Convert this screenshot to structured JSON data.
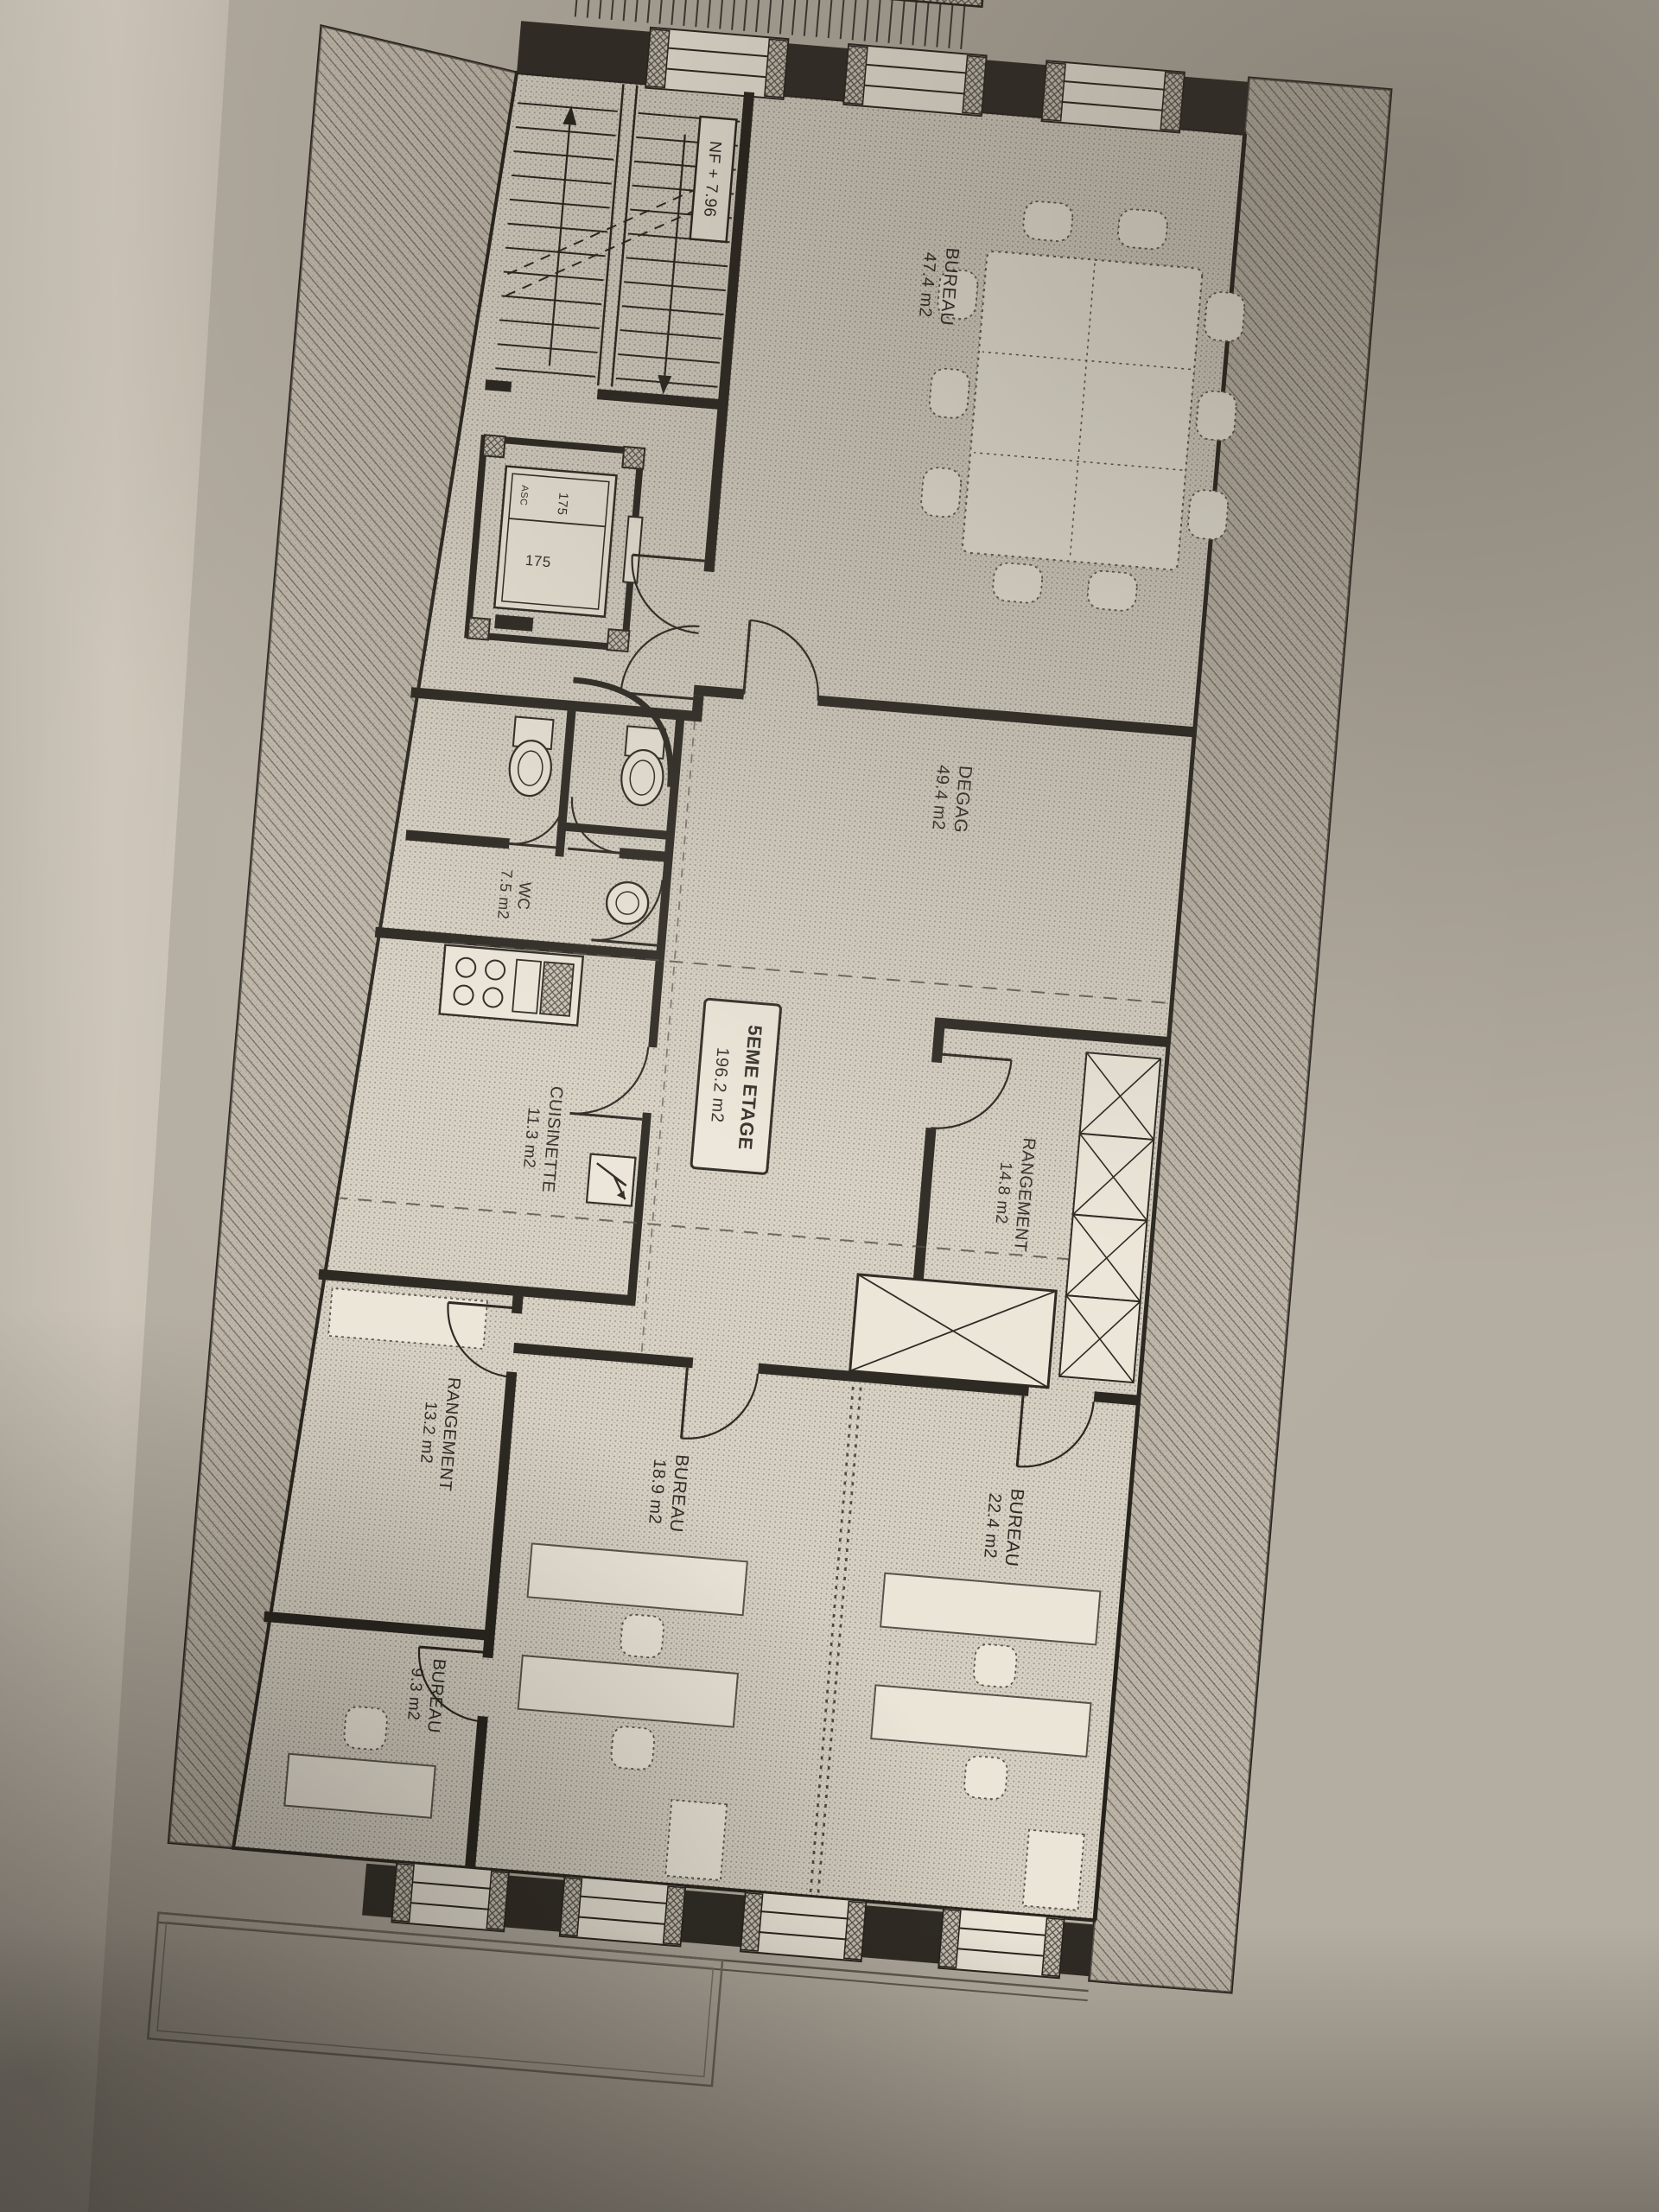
{
  "plan": {
    "floor_box": {
      "title": "5EME ETAGE",
      "area": "196.2 m2"
    },
    "level_marker": "NF + 7.96",
    "rooms": {
      "bureau_grand": {
        "name": "BUREAU",
        "area": "47.4 m2"
      },
      "degagement": {
        "name": "DEGAG",
        "area": "49.4 m2"
      },
      "rangement_haut": {
        "name": "RANGEMENT",
        "area": "14.8 m2"
      },
      "bureau_22": {
        "name": "BUREAU",
        "area": "22.4 m2"
      },
      "bureau_18": {
        "name": "BUREAU",
        "area": "18.9 m2"
      },
      "rangement_bas": {
        "name": "RANGEMENT",
        "area": "13.2 m2"
      },
      "bureau_9": {
        "name": "BUREAU",
        "area": "9.3 m2"
      },
      "cuisinette": {
        "name": "CUISINETTE",
        "area": "11.3 m2"
      },
      "wc": {
        "name": "WC",
        "area": "7.5 m2"
      }
    },
    "elevator": {
      "dim_a": "175",
      "dim_b": "175",
      "cabin_tag": "ASC"
    },
    "colors": {
      "ink": "#26221c",
      "paper": "#b4ada1",
      "floor_stipple": "#d6d0c3",
      "furniture": "#ebe5d8",
      "hatch_wall": "#b3ab9d"
    }
  }
}
